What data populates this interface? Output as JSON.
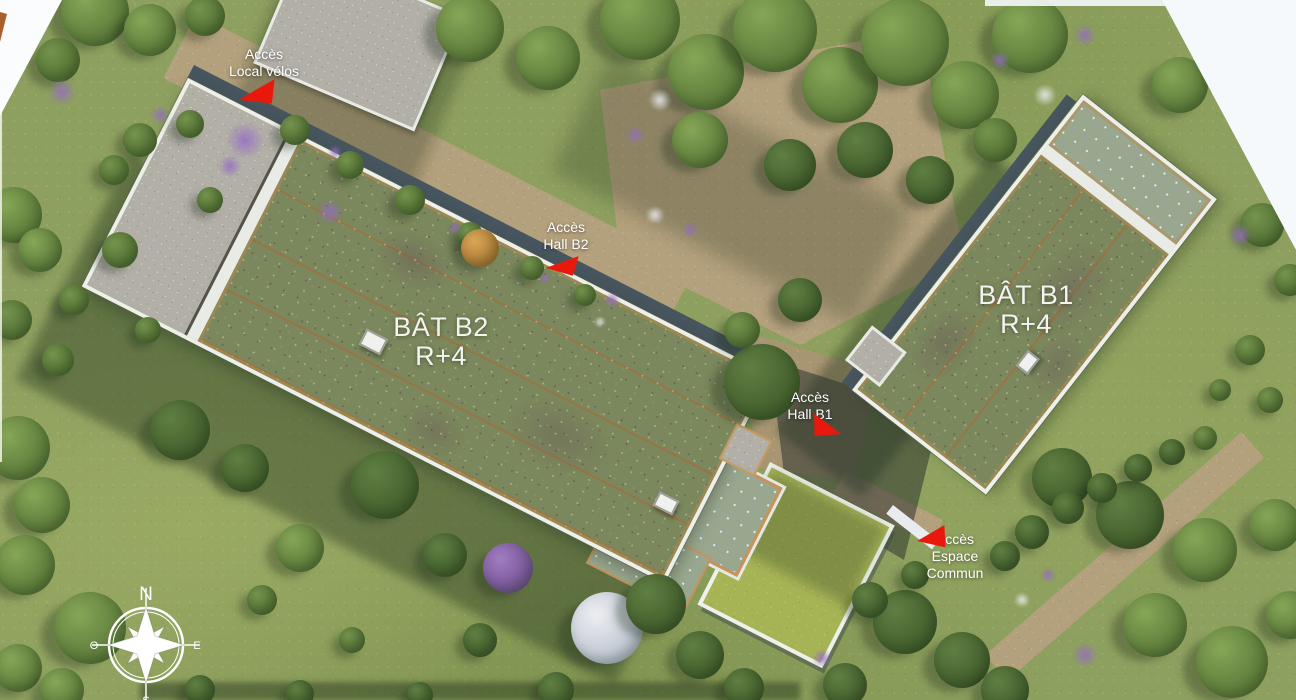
{
  "buildings": {
    "b2": {
      "name": "BÂT B2",
      "level": "R+4"
    },
    "b1": {
      "name": "BÂT B1",
      "level": "R+4"
    }
  },
  "annotations": {
    "local_velos": {
      "line1": "Accès",
      "line2": "Local vélos"
    },
    "hall_b2": {
      "line1": "Accès",
      "line2": "Hall B2"
    },
    "hall_b1": {
      "line1": "Accès",
      "line2": "Hall B1"
    },
    "espace_commun": {
      "line1": "Accès",
      "line2": "Espace",
      "line3": "Commun"
    }
  },
  "compass": {
    "north": "N",
    "south": "S",
    "east": "E",
    "west": "O"
  },
  "colors": {
    "arrow_red": "#e8190c",
    "label_text": "#ffffff",
    "roof_vegetation": "#7b875c",
    "grass": "#8ea05f",
    "path_sand": "#b3a07c",
    "parapet_white": "#edefe9",
    "gravel_grey": "#b2afa7",
    "lawn_green": "#a7b455"
  }
}
